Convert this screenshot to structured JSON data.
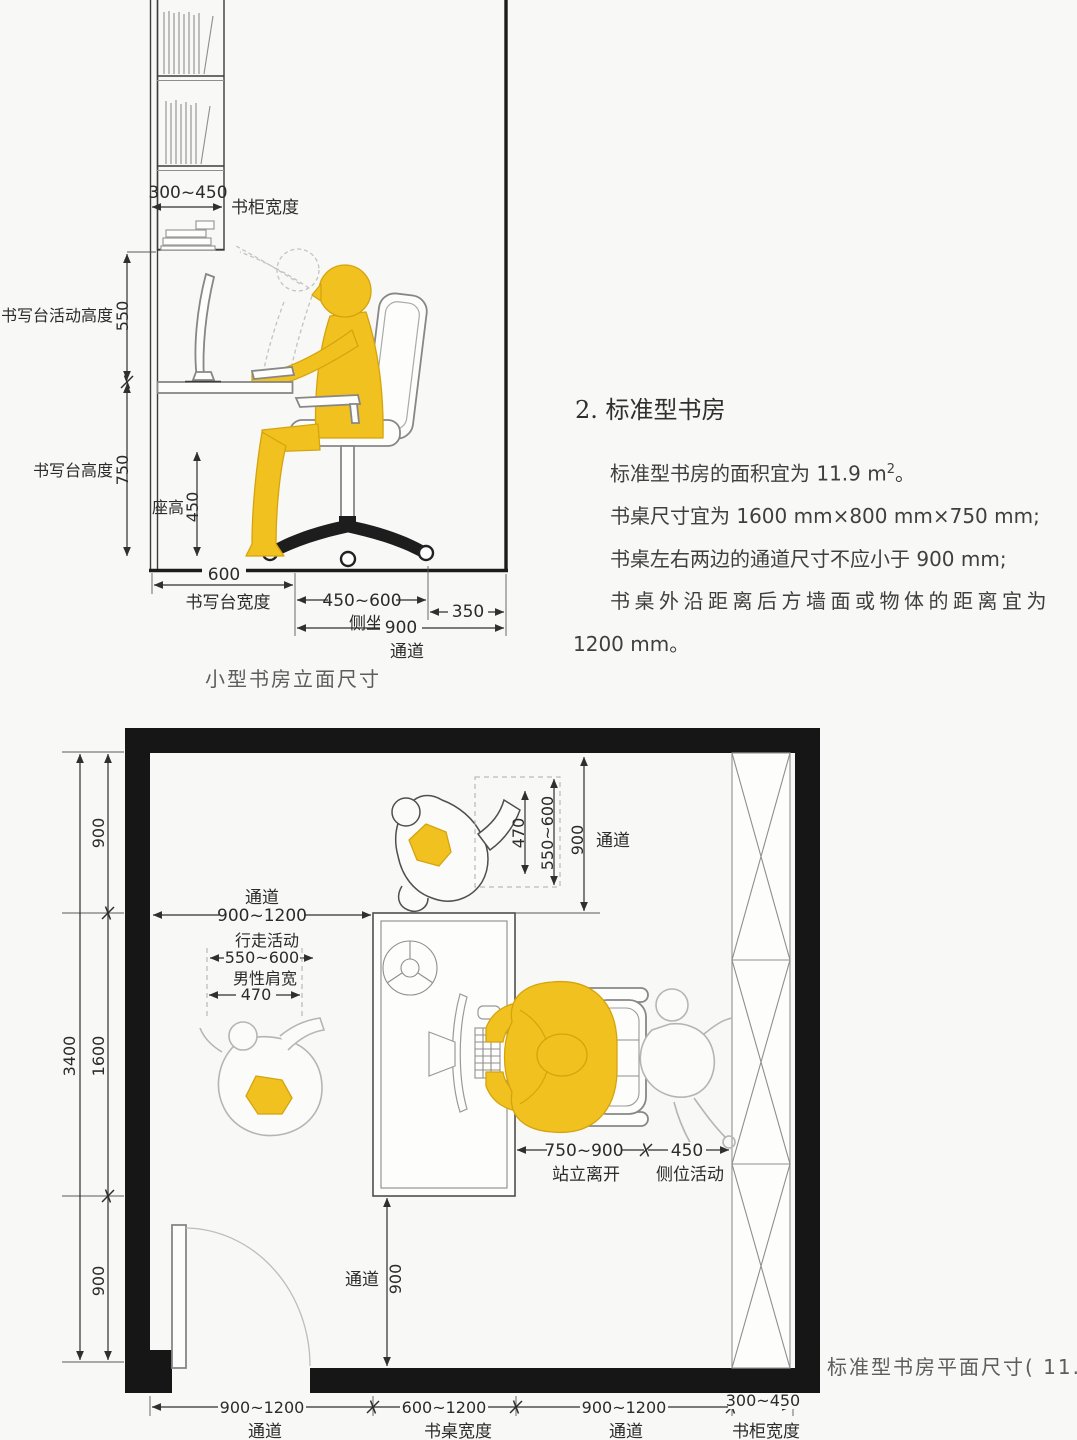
{
  "colors": {
    "accent_yellow": "#F1C120",
    "line_dark": "#2f2f2f",
    "wall_black": "#161616",
    "ghost_gray": "#c3c3c3",
    "background": "#f8f8f6"
  },
  "elevation": {
    "caption": "小型书房立面尺寸",
    "cabinet_width": {
      "value": "300~450",
      "label": "书柜宽度"
    },
    "desk_activity_height": {
      "label": "书写台活动高度",
      "value": "550"
    },
    "desk_height": {
      "label": "书写台高度",
      "value": "750"
    },
    "seat_height": {
      "label": "座高",
      "value": "450"
    },
    "desk_width": {
      "value": "600",
      "label": "书写台宽度"
    },
    "side_sit": {
      "value": "450~600",
      "label": "侧坐"
    },
    "rear_clearance": {
      "value": "350"
    },
    "passage": {
      "value": "900",
      "label": "通道"
    }
  },
  "notes": {
    "heading": "2. 标准型书房",
    "line1_prefix": "标准型书房的面积宜为 11.9 m",
    "line1_sup": "2",
    "line1_suffix": "。",
    "line2": "书桌尺寸宜为 1600 mm×800 mm×750 mm;",
    "line3": "书桌左右两边的通道尺寸不应小于 900 mm;",
    "line4": "书桌外沿距离后方墙面或物体的距离宜为",
    "line5": "1200 mm。"
  },
  "plan": {
    "caption_prefix": "标准型书房平面尺寸( 11.9 m",
    "caption_sup": "2",
    "caption_suffix": " )",
    "left_total": "3400",
    "left_segments": [
      "900",
      "1600",
      "900"
    ],
    "top_passage": {
      "label": "通道",
      "value": "900~1200"
    },
    "walking": {
      "label": "行走活动",
      "value": "550~600"
    },
    "shoulder": {
      "label": "男性肩宽",
      "value": "470"
    },
    "right_top": {
      "v470": "470",
      "v550": "550~600",
      "v900": "900",
      "passage_label": "通道"
    },
    "stand_leave": {
      "value": "750~900",
      "label": "站立离开"
    },
    "side_activity": {
      "value": "450",
      "label": "侧位活动"
    },
    "bottom_passage": {
      "label": "通道",
      "value": "900"
    },
    "bottom_dims": [
      {
        "value": "900~1200",
        "label": "通道"
      },
      {
        "value": "600~1200",
        "label": "书桌宽度"
      },
      {
        "value": "900~1200",
        "label": "通道"
      },
      {
        "value": "300~450",
        "label": "书柜宽度"
      }
    ]
  }
}
